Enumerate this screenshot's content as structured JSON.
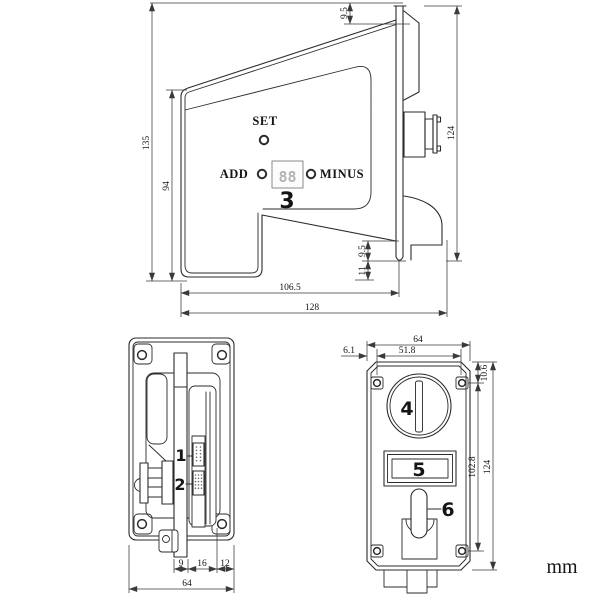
{
  "unit": "mm",
  "colors": {
    "line": "#2b2b2b",
    "background": "#ffffff",
    "segment_digits": "#b2b2b2"
  },
  "side": {
    "set": "SET",
    "add": "ADD",
    "minus": "MINUS",
    "digits": "88",
    "callout": "3",
    "d_total_height": "135",
    "d_body_height": "94",
    "d_top_offset": "9.5",
    "d_plate_height": "124",
    "d_flange_offset": "9.5",
    "d_bottom_offset": "11",
    "d_body_depth": "106.5",
    "d_total_depth": "128"
  },
  "rear": {
    "callout_1": "1",
    "callout_2": "2",
    "d_seg1": "9",
    "d_seg2": "16",
    "d_seg3": "12",
    "d_width": "64"
  },
  "front": {
    "callout_4": "4",
    "callout_5": "5",
    "callout_6": "6",
    "d_width": "64",
    "d_edge_offset": "6.1",
    "d_hole_span_h": "51.8",
    "d_hole_top": "10.6",
    "d_hole_span_v": "102.8",
    "d_height": "124"
  }
}
